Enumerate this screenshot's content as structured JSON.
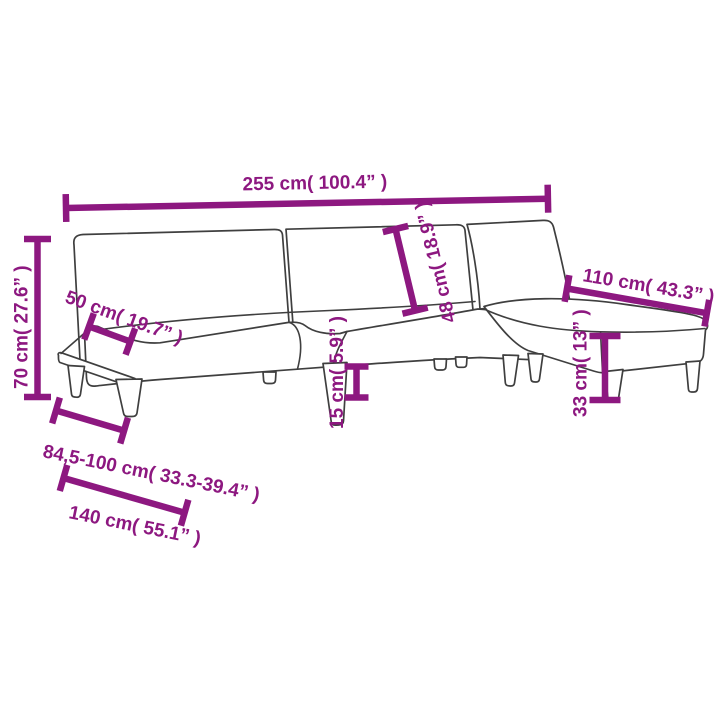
{
  "page": {
    "background_color": "#ffffff",
    "subject": "L-shaped sofa bed with footstool - dimension diagram",
    "dimension_color": "#8d1880",
    "outline_color": "#3f3f3f"
  },
  "measurements": {
    "total_width": {
      "label": "255 cm( 100.4” )",
      "cm": "255",
      "inches": "100.4"
    },
    "total_height": {
      "label": "70 cm( 27.6” )",
      "cm": "70",
      "inches": "27.6"
    },
    "armrest_depth": {
      "label": "50 cm( 19.7” )",
      "cm": "50",
      "inches": "19.7"
    },
    "backrest_height": {
      "label": "48 cm( 18.9” )",
      "cm": "48",
      "inches": "18.9"
    },
    "leg_height": {
      "label": "15 cm( 5.9” )",
      "cm": "15",
      "inches": "5.9"
    },
    "footstool_length": {
      "label": "110 cm( 43.3” )",
      "cm": "110",
      "inches": "43.3"
    },
    "footstool_height": {
      "label": "33 cm( 13” )",
      "cm": "33",
      "inches": "13"
    },
    "depth_range": {
      "label": "84,5-100 cm( 33.3-39.4” )",
      "cm": "84,5-100",
      "inches": "33.3-39.4"
    },
    "seat_length": {
      "label": "140 cm( 55.1” )",
      "cm": "140",
      "inches": "55.1"
    }
  }
}
